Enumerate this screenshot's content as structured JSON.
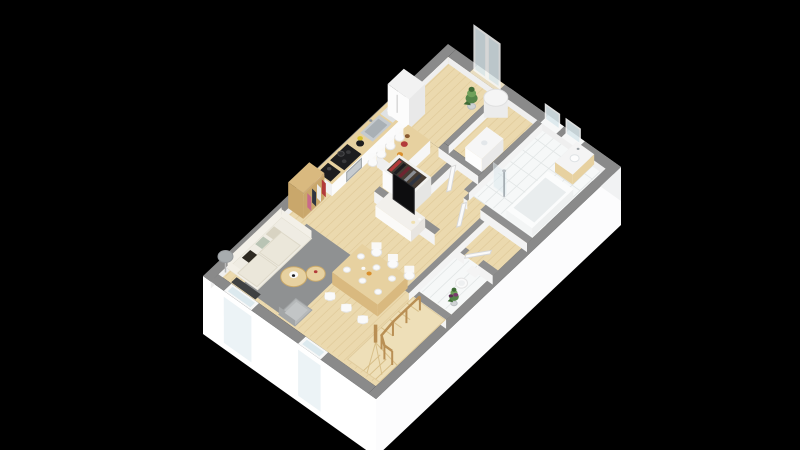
{
  "scene": {
    "kind": "3d-floorplan-render",
    "view": "isometric-top-down",
    "floor_label": "ground floor",
    "background": "#000000",
    "width": 800,
    "height": 450
  },
  "palette": {
    "background": "#000000",
    "wallTop": "#8a8a8a",
    "wallTopInner": "#8f8f8f",
    "wallFace": "#f3f3f3",
    "innerFace": "#efefef",
    "extFaceSW": "#ffffff",
    "extFaceSE": "#fcfcfd",
    "extFaceNE": "#f1f2f3",
    "floorWood": "#ebd9ae",
    "floorPlank": "#d9c08c",
    "tile": "#f6f8f8",
    "tileLine": "#e2e6e6",
    "glass": "#dce9ee",
    "frameWhite": "#f7f8f8",
    "doorLeaf": "#fafafa",
    "doorEdge": "#d8d8d8",
    "threshold": "#e9ddc0",
    "rug": "#8f9192",
    "sofa": "#efece3",
    "sofaTrim": "#e3dfd2",
    "sofaBack": "#f3f0e8",
    "cushionDark": "#2e2a22",
    "cushionSage": "#b9c4b4",
    "cushionBeige": "#d8d3c2",
    "woodLight": "#e7d1a0",
    "woodMid": "#d9b97f",
    "woodDark": "#c9a76b",
    "woodEdge": "#caa96a",
    "stairWood": "#eedfb8",
    "stairLine": "#d6bc85",
    "rail": "#b98f54",
    "white": "#fafafa",
    "whiteEdge": "#e4e4e4",
    "steel": "#c6cbcf",
    "steelDark": "#a9b0b5",
    "appliance": "#1d1d1f",
    "applianceMid": "#3a3a3c",
    "gray": "#b6b9ba",
    "grayDark": "#a3a6a7",
    "radiator": "#3f4142",
    "plant": "#558549",
    "plantDark": "#3f6b36",
    "plantLight": "#6fa05a",
    "accentRed": "#b23a3a",
    "accentOrange": "#d98e2b",
    "accentNavy": "#2e3440",
    "accentPink": "#c96a8a",
    "accentMaroon": "#6e2430",
    "shoePurple": "#7a3b6e",
    "lampShade": "#a7acae",
    "heater": "#ececec",
    "black": "#0d0d0f"
  },
  "rooms": [
    {
      "id": "kitchen",
      "label": "open kitchen",
      "items": [
        {
          "id": "fridge",
          "label": "tall fridge"
        },
        {
          "id": "kitchen-counter",
          "label": "counter with wood worktop"
        },
        {
          "id": "sink",
          "label": "stainless double sink"
        },
        {
          "id": "dish-rack",
          "label": "dish rack with plates"
        },
        {
          "id": "blender",
          "label": "blender"
        },
        {
          "id": "induction-hob",
          "label": "black induction hob with pot"
        },
        {
          "id": "oven",
          "label": "built-in oven"
        },
        {
          "id": "coffee-machine",
          "label": "coffee machine"
        },
        {
          "id": "kitchen-island",
          "label": "breakfast bar island"
        },
        {
          "id": "bar-stool",
          "label": "white bar stool",
          "count": 4
        },
        {
          "id": "bookshelf",
          "label": "wooden bookshelf with books"
        }
      ]
    },
    {
      "id": "living-room",
      "label": "living room",
      "items": [
        {
          "id": "sofa",
          "label": "cream three-seat sofa with cushions"
        },
        {
          "id": "floor-lamp",
          "label": "tripod floor lamp"
        },
        {
          "id": "rug",
          "label": "grey area rug"
        },
        {
          "id": "coffee-table",
          "label": "round wooden nesting table",
          "count": 2
        },
        {
          "id": "armchair",
          "label": "grey armchair"
        },
        {
          "id": "radiator",
          "label": "wall radiator"
        },
        {
          "id": "tv-stand",
          "label": "media unit"
        },
        {
          "id": "tv",
          "label": "flat-screen TV"
        }
      ]
    },
    {
      "id": "dining-area",
      "label": "dining area",
      "items": [
        {
          "id": "dining-table",
          "label": "wooden dining table with place settings"
        },
        {
          "id": "dining-chair",
          "label": "white dining chair",
          "count": 6
        }
      ]
    },
    {
      "id": "hallway",
      "label": "entry hallway",
      "items": [
        {
          "id": "wardrobe",
          "label": "open wardrobe with clothes"
        },
        {
          "id": "door",
          "label": "white interior door",
          "count": 3
        }
      ]
    },
    {
      "id": "technical-room",
      "label": "technical room",
      "items": [
        {
          "id": "water-heater",
          "label": "cylindrical water heater"
        },
        {
          "id": "washing-machine",
          "label": "washing machine"
        }
      ]
    },
    {
      "id": "bathroom",
      "label": "bathroom",
      "items": [
        {
          "id": "bathtub",
          "label": "bathtub"
        },
        {
          "id": "vanity",
          "label": "wood vanity with basin"
        },
        {
          "id": "shower",
          "label": "walk-in shower with glass panel"
        },
        {
          "id": "bathroom-window",
          "label": "small window",
          "count": 2
        }
      ]
    },
    {
      "id": "wc",
      "label": "WC",
      "items": [
        {
          "id": "toilet",
          "label": "toilet"
        }
      ]
    },
    {
      "id": "staircase",
      "label": "winder staircase",
      "items": [
        {
          "id": "stairs",
          "label": "light wood winding stairs"
        },
        {
          "id": "railing",
          "label": "wood railing with balusters"
        }
      ]
    },
    {
      "id": "exterior",
      "label": "envelope / openings",
      "items": [
        {
          "id": "patio-doors",
          "label": "tall glazed patio doors (NE wall)"
        },
        {
          "id": "window-sw",
          "label": "window on SW wall",
          "count": 2
        },
        {
          "id": "plant",
          "label": "green potted plant",
          "count": 2
        },
        {
          "id": "shoes",
          "label": "purple shoes by stairs"
        }
      ]
    }
  ]
}
